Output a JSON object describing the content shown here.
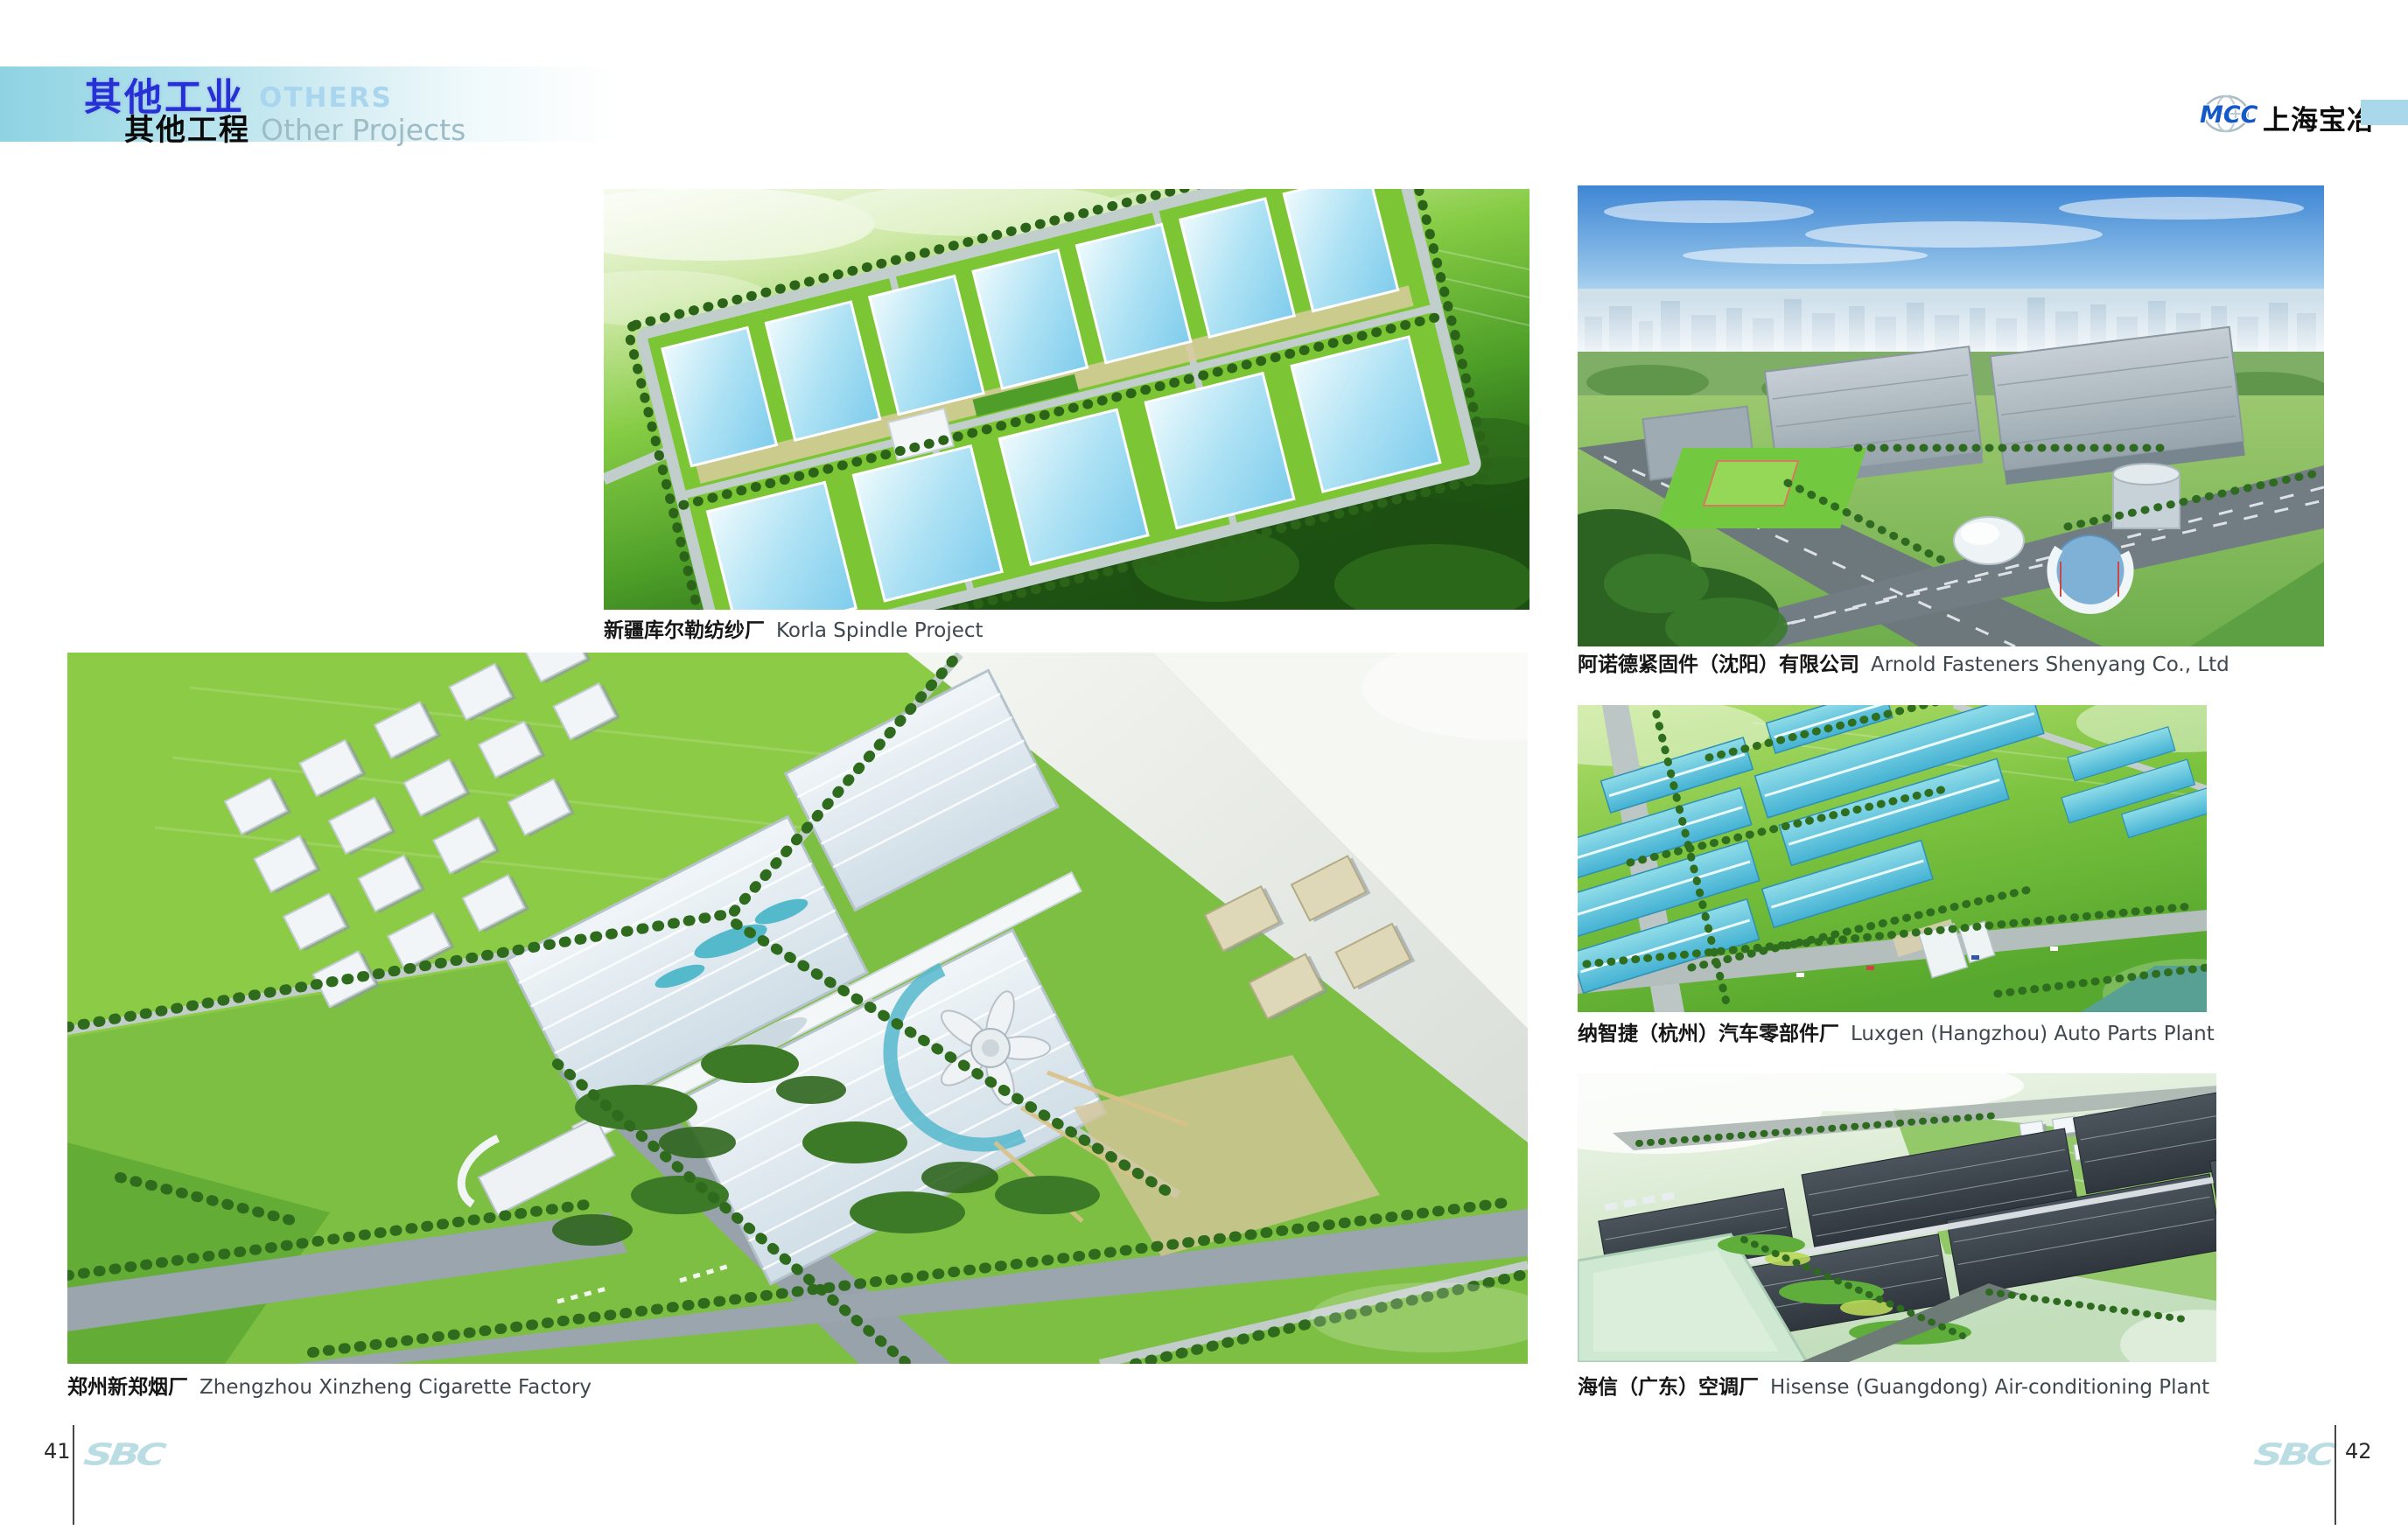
{
  "header": {
    "title_zh": "其他工业",
    "title_en": "OTHERS",
    "subtitle_zh": "其他工程",
    "subtitle_en": "Other Projects",
    "title_zh_color": "#2531d4",
    "title_en_color": "#a9d6ee",
    "subtitle_en_color": "#9dbcc6",
    "bar_color": "#8ed3e2"
  },
  "brand": {
    "mcc_text": "MCC",
    "company_zh": "上海宝冶",
    "mcc_color": "#1558c8",
    "accent_bar_color": "#a9d8ea"
  },
  "figures": [
    {
      "caption_zh": "新疆库尔勒纺纱厂",
      "caption_en": "Korla Spindle Project",
      "alt": "Aerial rendering of a spinning-mill campus with rows of light-blue roofed workshops on green land"
    },
    {
      "caption_zh": "阿诺德紧固件（沈阳）有限公司",
      "caption_en": "Arnold Fasteners Shenyang Co., Ltd",
      "alt": "Aerial rendering of gray factory halls with lawn, dome, tank and round glass building against a city skyline"
    },
    {
      "caption_zh": "纳智捷（杭州）汽车零部件厂",
      "caption_en": "Luxgen (Hangzhou) Auto Parts Plant",
      "alt": "Aerial rendering of teal-roofed auto parts workshops in green fields with a river at lower right"
    },
    {
      "caption_zh": "海信（广东）空调厂",
      "caption_en": "Hisense (Guangdong) Air-conditioning Plant",
      "alt": "Aerial rendering of long dark-roofed production halls beside a pale green pond and white dormitories"
    },
    {
      "caption_zh": "郑州新郑烟厂",
      "caption_en": "Zhengzhou Xinzheng Cigarette Factory",
      "alt": "Large aerial rendering of a cigarette factory campus with white buildings, flower-shaped tower and road intersection"
    }
  ],
  "footer": {
    "left_page_number": "41",
    "right_page_number": "42",
    "logo_text": "SBC",
    "logo_color": "#b9dde2"
  }
}
